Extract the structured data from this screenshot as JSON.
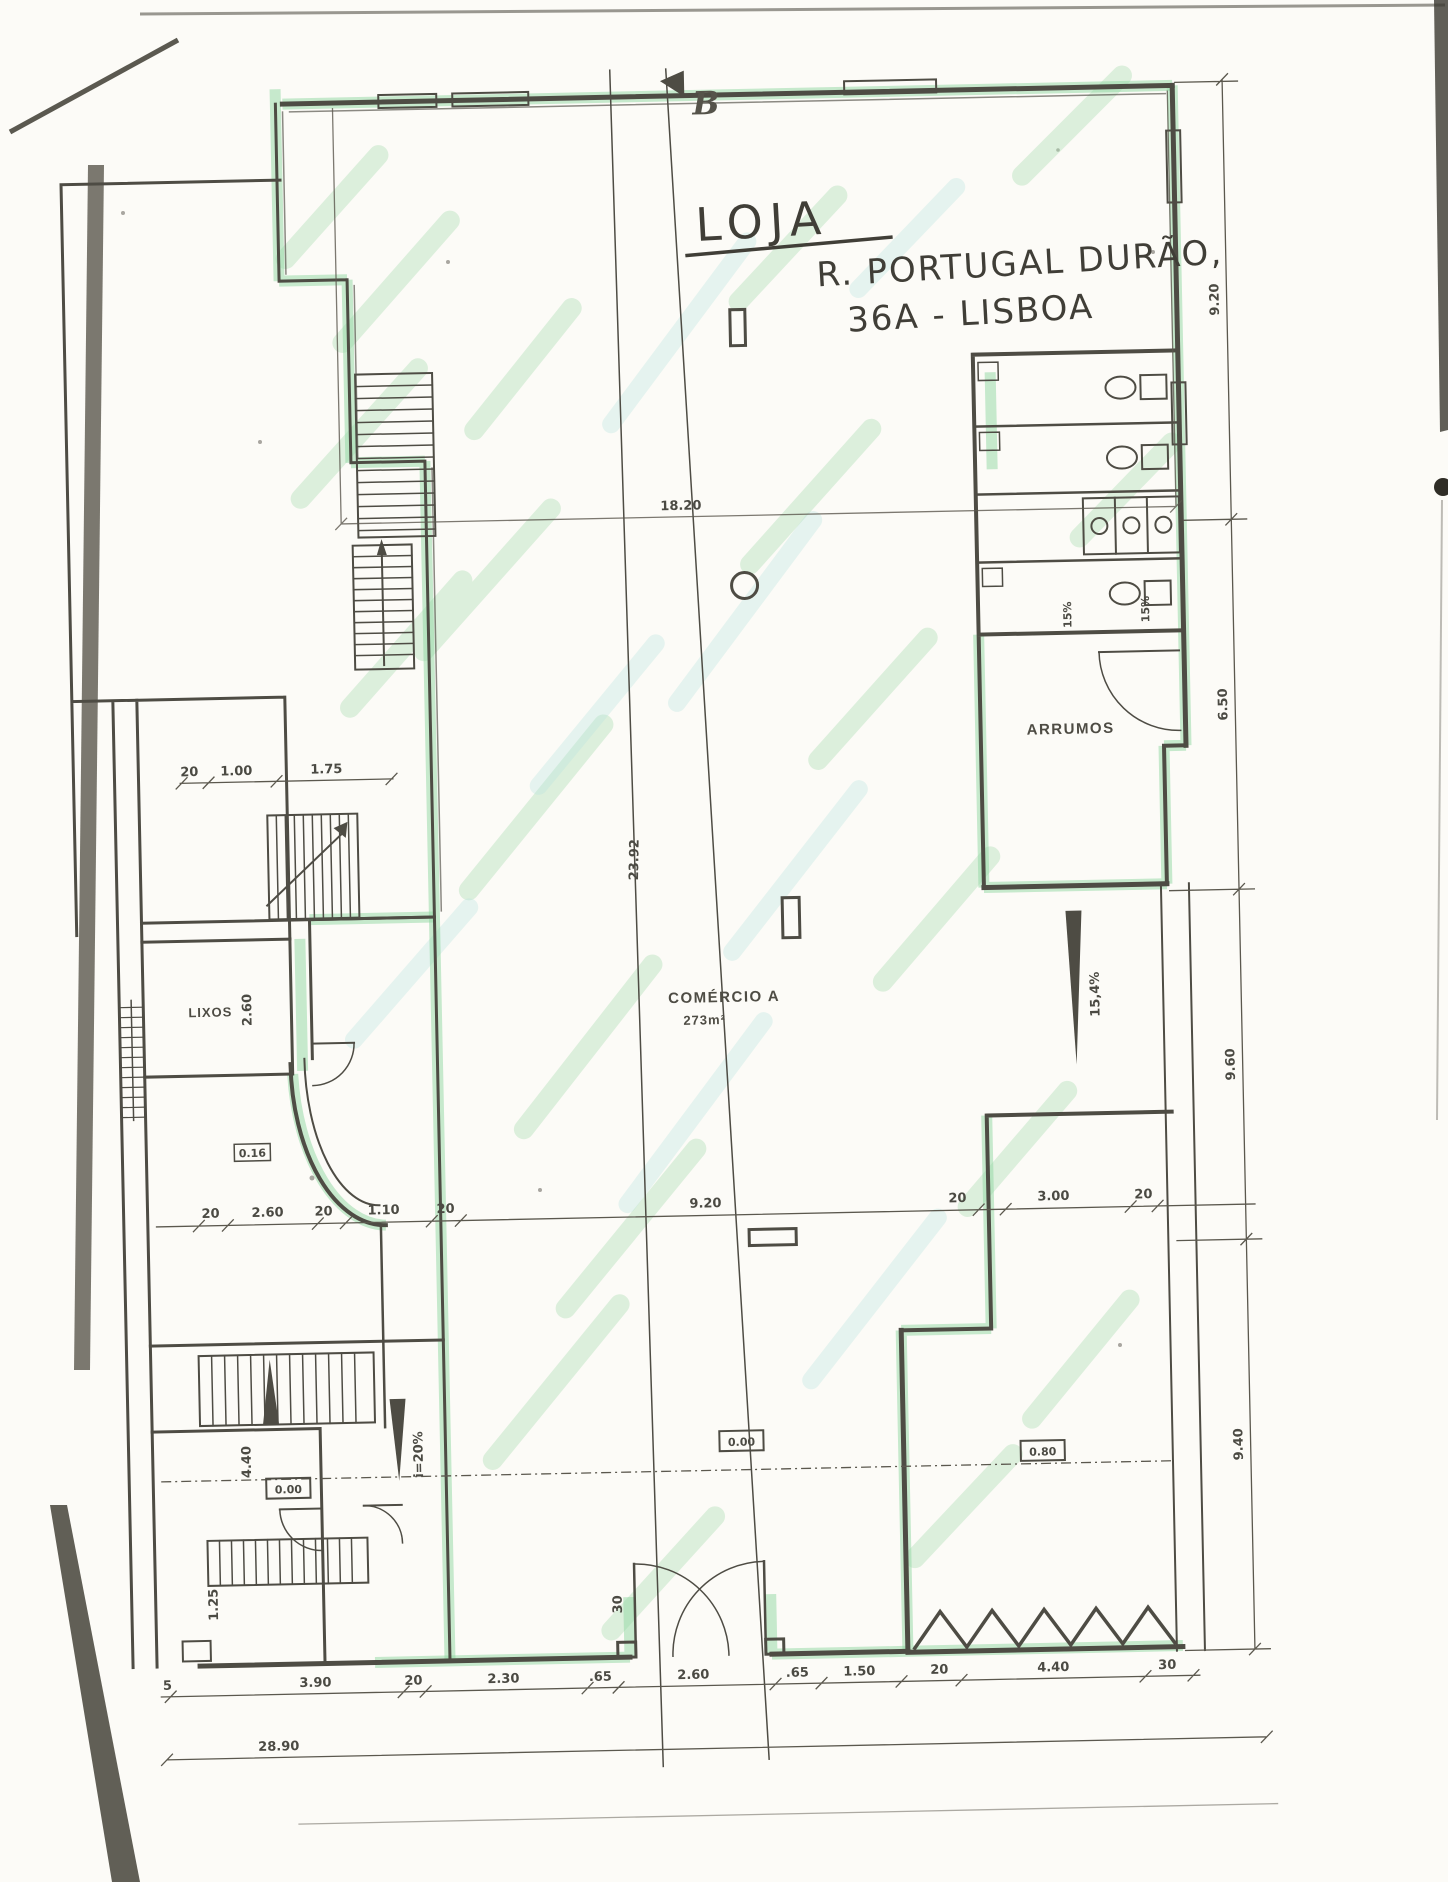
{
  "doc": {
    "marker_b": "B",
    "title": {
      "l1": "LOJA",
      "l2": "R. PORTUGAL DURÃO,",
      "l3": "36A - LISBOA"
    },
    "rooms": {
      "arrumos": "ARRUMOS",
      "lixos": "LIXOS",
      "comercio": "COMÉRCIO A",
      "comercio_area": "273m²"
    },
    "levels": {
      "left": "0.00",
      "center": "0.00",
      "right": "0.80",
      "upper": "0.16"
    },
    "slopes": {
      "left_ramp": "i=20%",
      "right_ramp": "15,4%",
      "wc_a": "15%",
      "wc_b": "15%"
    },
    "dims": {
      "top": "18.20",
      "right": [
        "9.20",
        "6.50",
        "9.60",
        "9.40"
      ],
      "mid": [
        "20",
        "2.60",
        "20",
        "1.10",
        "20",
        "9.20",
        "20",
        "3.00",
        "20"
      ],
      "bottom": [
        "5",
        "3.90",
        "20",
        "2.30",
        ".65",
        "2.60",
        ".65",
        "1.50",
        "20",
        "4.40",
        "30"
      ],
      "total": "28.90",
      "upper_left": [
        "20",
        "1.00",
        "1.75"
      ],
      "lixos_height": "2.60",
      "room_height": "4.40",
      "step_width": "1.25",
      "door_jamb": "30",
      "section_length": "23.92"
    }
  }
}
